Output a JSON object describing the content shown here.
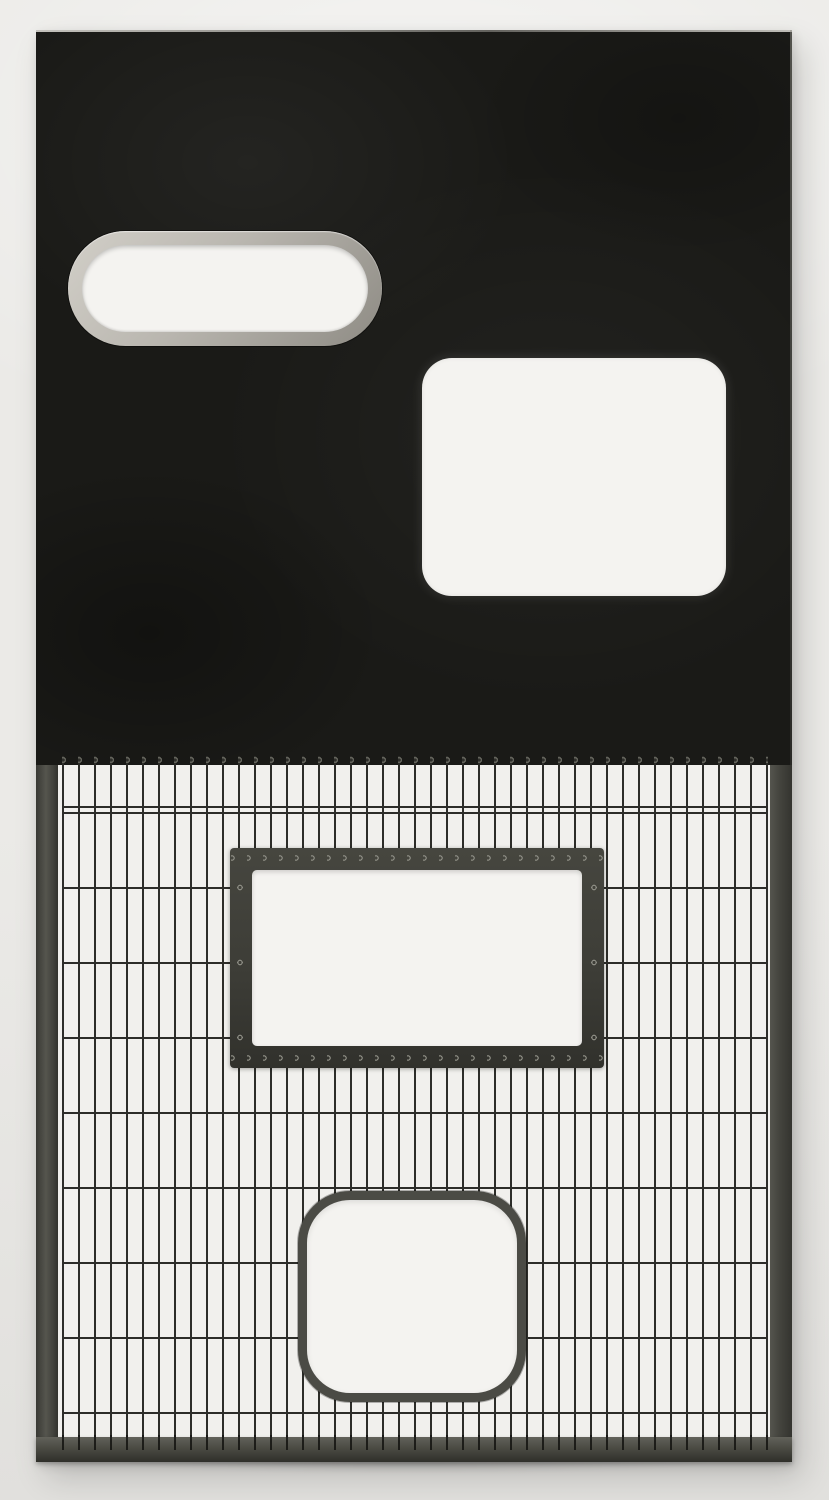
{
  "scene": {
    "kind": "photograph-of-object",
    "subject": "freestanding two-part metal screen panel photographed against a plain light backdrop",
    "upper_half": "solid black sheet-metal panel with two cut-out windows",
    "lower_half": "welded wire grid with two framed openings and a bottom rail"
  },
  "colors": {
    "background_top": "#ebeae7",
    "background_bottom": "#e1e0dd",
    "panel_black": "#1a1a17",
    "frame_gray": "#45453f",
    "rail_gray": "#4a4a43",
    "wire": "#2d2d29",
    "window_frame": "#3d3d37",
    "rim_light": "#d2cfc8",
    "rim_dark": "#8e8b84",
    "cutout_white": "#f4f3f0",
    "mesh_backdrop": "#f1f0ed"
  },
  "parts": {
    "artwork": {
      "left": 36,
      "top": 30,
      "width": 756,
      "height": 1432
    },
    "solid_panel": {
      "left": 0,
      "top": 0,
      "width": 756,
      "height": 735,
      "finish": "matte mottled black"
    },
    "oval_porthole": {
      "left": 32,
      "top": 201,
      "width": 314,
      "height": 115,
      "rim": "stainless steel, ~14px thick, fully rounded ends"
    },
    "rect_cutout": {
      "left": 386,
      "top": 328,
      "width": 304,
      "height": 238,
      "corner_radius": 30
    },
    "mesh": {
      "top": 735,
      "height": 672,
      "vertical_wires": {
        "count": 45,
        "spacing_px": 16,
        "thickness_px": 2,
        "top_detail": "small looped ends hooked to panel"
      },
      "horizontal_wires": {
        "count": 9,
        "spacing_px": 75,
        "thickness_px": 2,
        "end_detail": "looped ends hooked to side bars"
      },
      "side_bars": {
        "width": 22
      }
    },
    "window_rect": {
      "left": 194,
      "top": 83,
      "width": 374,
      "height": 220,
      "frame_thickness": 22,
      "detail": "wire loops riveted around all four frame edges"
    },
    "window_rounded": {
      "left": 262,
      "top": 426,
      "width": 228,
      "height": 211,
      "rim_thickness": 9,
      "corner_radius": 52
    },
    "bottom_rail": {
      "top": 1407,
      "height": 25,
      "detail": "wire tips lap over the rail"
    }
  }
}
